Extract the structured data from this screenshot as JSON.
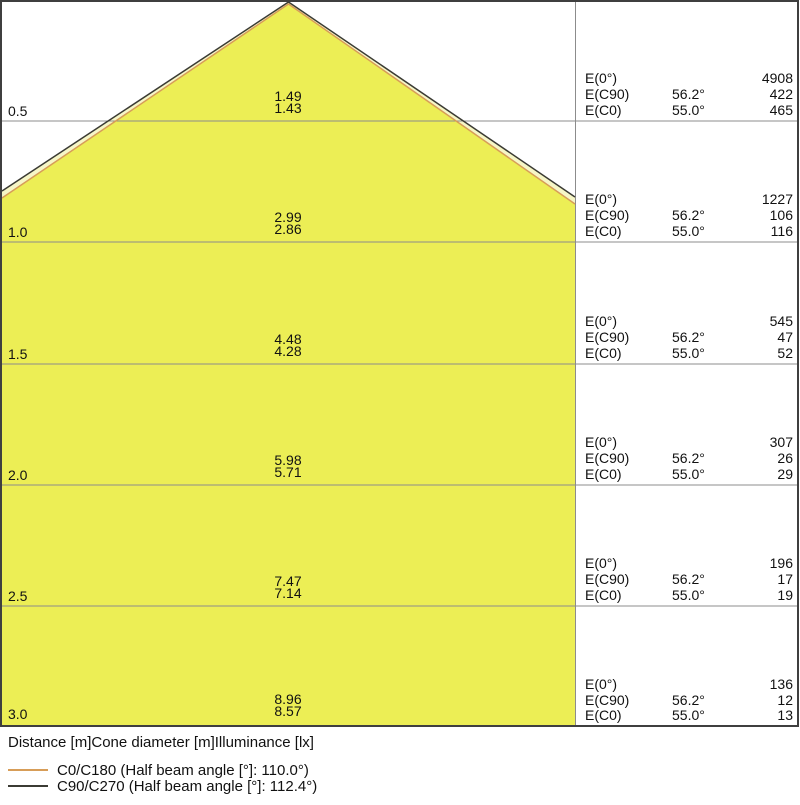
{
  "colors": {
    "cone_fill": "#ECEE55",
    "cone_band_fill": "#F6F6C6",
    "grid_line": "#8C8C8C",
    "border": "#3F3F3F",
    "background": "#FFFFFF"
  },
  "axis_header": "Distance [m]Cone diameter [m]Illuminance [lx]",
  "legend": [
    {
      "label": "C0/C180 (Half beam angle [°]: 110.0°)",
      "color": "#D79D58"
    },
    {
      "label": "C90/C270 (Half beam angle [°]: 112.4°)",
      "color": "#3B3B34"
    }
  ],
  "e_labels": [
    "E(0°)",
    "E(C90)",
    "E(C0)"
  ],
  "rows": [
    {
      "distance": "0.5",
      "cone": [
        "1.49",
        "1.43"
      ],
      "illuminance": {
        "e0": "4908",
        "ec90_angle": "56.2°",
        "ec90": "422",
        "ec0_angle": "55.0°",
        "ec0": "465"
      }
    },
    {
      "distance": "1.0",
      "cone": [
        "2.99",
        "2.86"
      ],
      "illuminance": {
        "e0": "1227",
        "ec90_angle": "56.2°",
        "ec90": "106",
        "ec0_angle": "55.0°",
        "ec0": "116"
      }
    },
    {
      "distance": "1.5",
      "cone": [
        "4.48",
        "4.28"
      ],
      "illuminance": {
        "e0": "545",
        "ec90_angle": "56.2°",
        "ec90": "47",
        "ec0_angle": "55.0°",
        "ec0": "52"
      }
    },
    {
      "distance": "2.0",
      "cone": [
        "5.98",
        "5.71"
      ],
      "illuminance": {
        "e0": "307",
        "ec90_angle": "56.2°",
        "ec90": "26",
        "ec0_angle": "55.0°",
        "ec0": "29"
      }
    },
    {
      "distance": "2.5",
      "cone": [
        "7.47",
        "7.14"
      ],
      "illuminance": {
        "e0": "196",
        "ec90_angle": "56.2°",
        "ec90": "17",
        "ec0_angle": "55.0°",
        "ec0": "19"
      }
    },
    {
      "distance": "3.0",
      "cone": [
        "8.96",
        "8.57"
      ],
      "illuminance": {
        "e0": "136",
        "ec90_angle": "56.2°",
        "ec90": "12",
        "ec0_angle": "55.0°",
        "ec0": "13"
      }
    }
  ],
  "chart_data": {
    "type": "area",
    "title": "",
    "xlabel": "Distance [m]",
    "ylabel": "Cone diameter [m] / Illuminance [lx]",
    "distances_m": [
      0.5,
      1.0,
      1.5,
      2.0,
      2.5,
      3.0
    ],
    "series": [
      {
        "name": "C0/C180 (Half beam angle [°]: 110.0°)",
        "half_beam_angle_deg": 55.0,
        "cone_diameter_m": [
          1.43,
          2.86,
          4.28,
          5.71,
          7.14,
          8.57
        ],
        "color": "#D79D58"
      },
      {
        "name": "C90/C270 (Half beam angle [°]: 112.4°)",
        "half_beam_angle_deg": 56.2,
        "cone_diameter_m": [
          1.49,
          2.99,
          4.48,
          5.98,
          7.47,
          8.96
        ],
        "color": "#3B3B34"
      }
    ],
    "illuminance_lx": [
      {
        "name": "E(0°)",
        "values": [
          4908,
          1227,
          545,
          307,
          196,
          136
        ]
      },
      {
        "name": "E(C90)",
        "angle": "56.2°",
        "values": [
          422,
          106,
          47,
          26,
          17,
          12
        ]
      },
      {
        "name": "E(C0)",
        "angle": "55.0°",
        "values": [
          465,
          116,
          52,
          29,
          19,
          13
        ]
      }
    ],
    "legend_position": "bottom",
    "grid": true
  }
}
